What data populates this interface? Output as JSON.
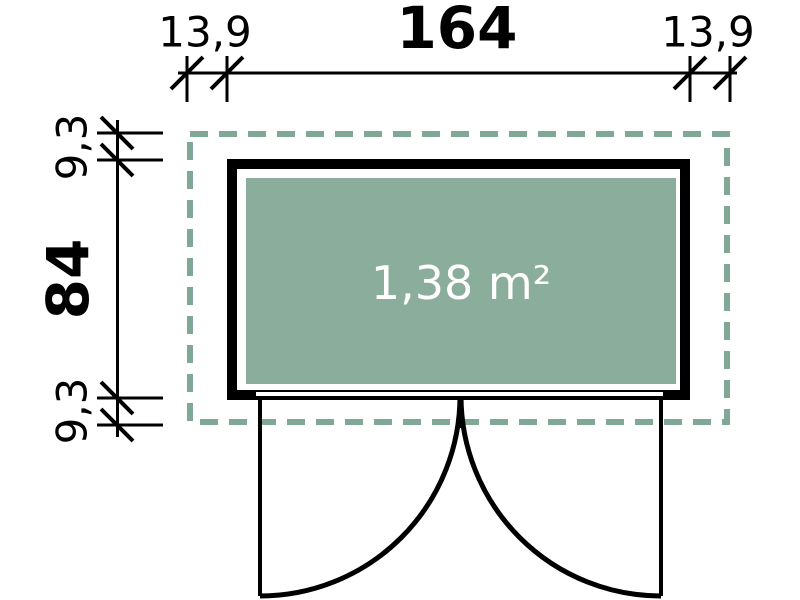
{
  "drawing": {
    "title": "floor-plan",
    "area_label": "1,38 m²",
    "dim_top": {
      "left_overhang": "13,9",
      "width": "164",
      "right_overhang": "13,9"
    },
    "dim_left": {
      "top_overhang": "9,3",
      "depth": "84",
      "bottom_overhang": "9,3"
    }
  },
  "colors": {
    "roof_dash": "#7FA896",
    "floor_fill": "#8BAD9C",
    "line": "#000000",
    "area_text": "#FFFFFF"
  }
}
